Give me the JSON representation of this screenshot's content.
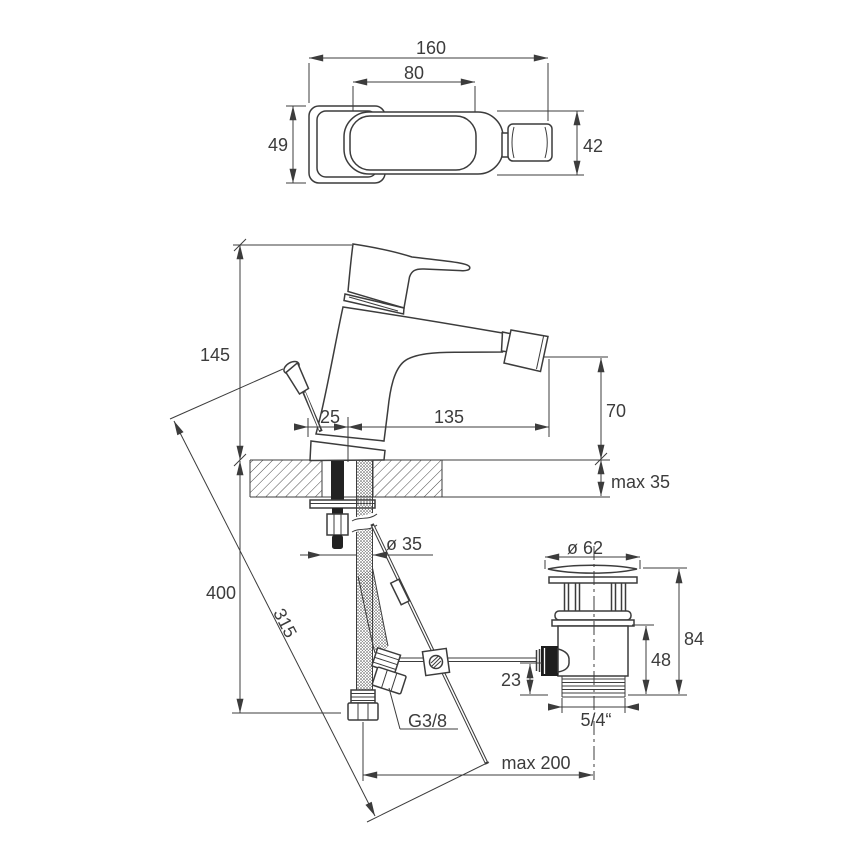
{
  "meta": {
    "title": "Bidet mixer tap installation dimensional drawing"
  },
  "colors": {
    "line": "#3c3c3c",
    "background": "#ffffff"
  },
  "labels": {
    "top_length": "160",
    "handle_length": "80",
    "left_width": "49",
    "right_width": "42",
    "body_height": "145",
    "rod_offset": "25",
    "spout_reach": "135",
    "spout_height": "70",
    "deck_thickness": "max 35",
    "hole_diameter": "ø 35",
    "hose_drop": "400",
    "rod_length": "315",
    "hose_thread": "G3/8",
    "reach_max": "max 200",
    "waste_diameter": "ø 62",
    "waste_height": "84",
    "waste_body_height": "48",
    "waste_inlet_offset": "23",
    "waste_thread": "5/4“"
  }
}
